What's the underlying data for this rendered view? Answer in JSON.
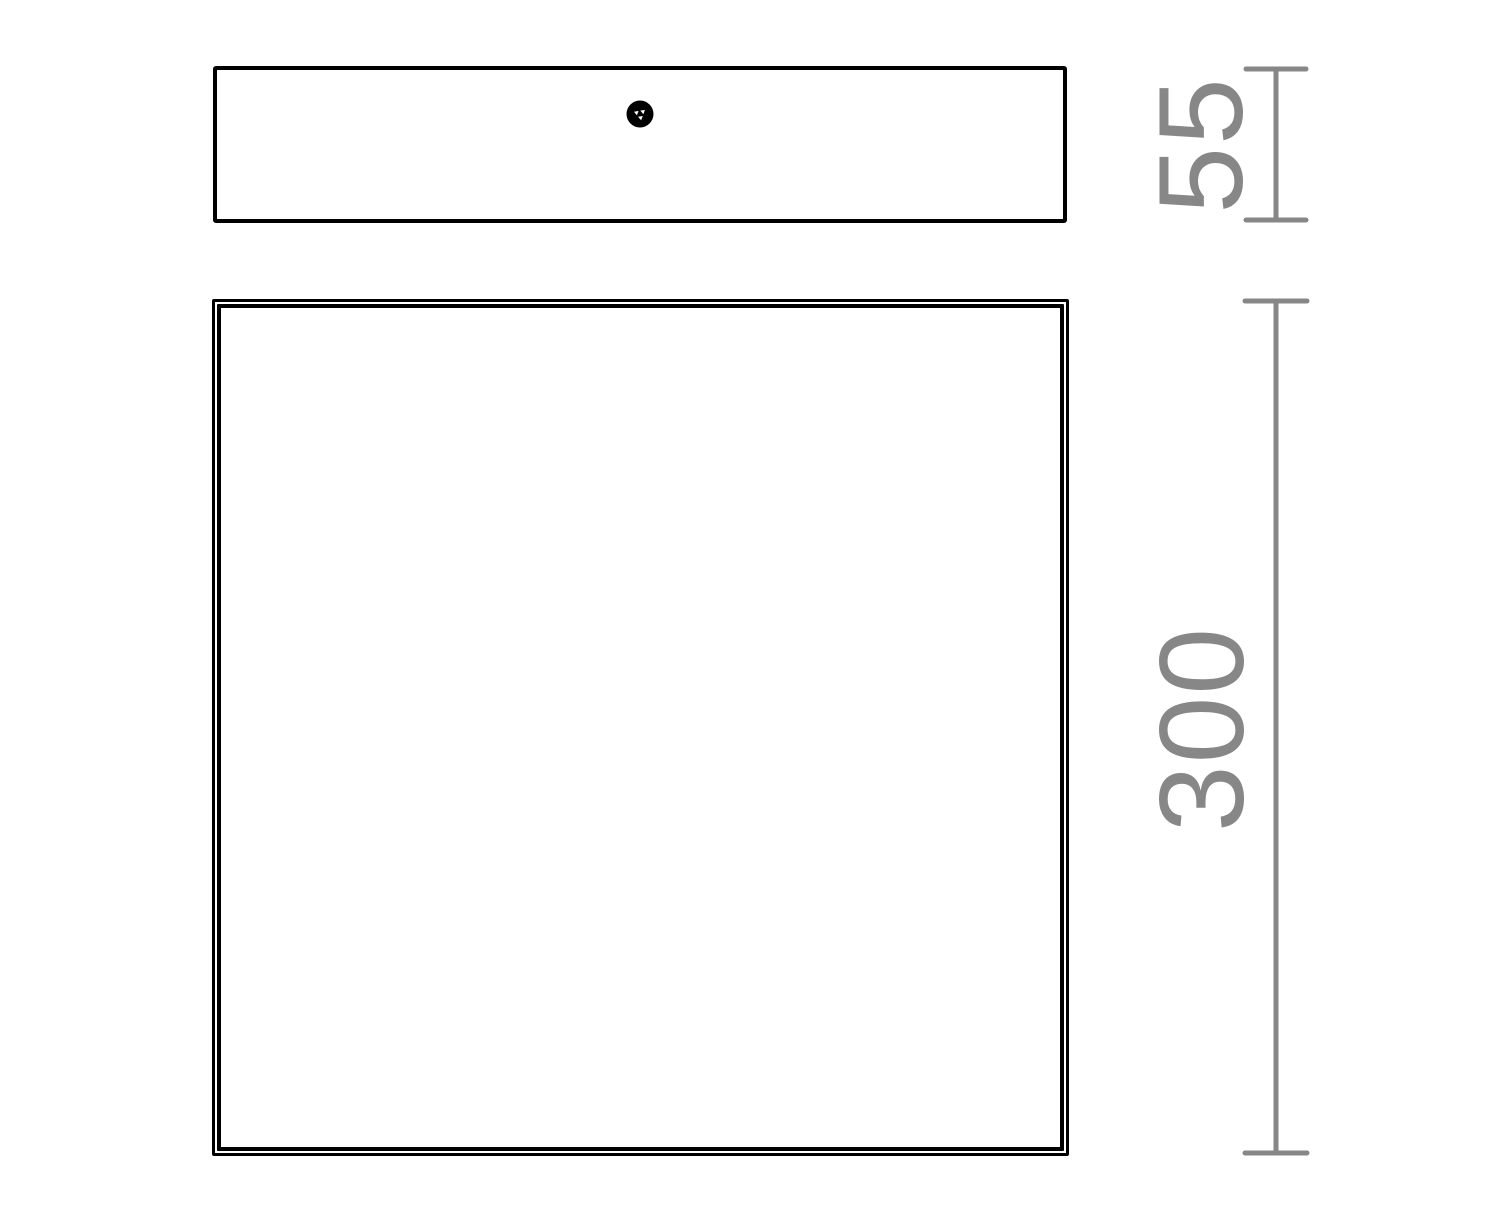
{
  "drawing": {
    "dimensions": {
      "side_height": {
        "label": "55"
      },
      "front_height": {
        "label": "300"
      }
    },
    "colors": {
      "outline": "#000000",
      "dimension_gray": "#878787"
    }
  }
}
